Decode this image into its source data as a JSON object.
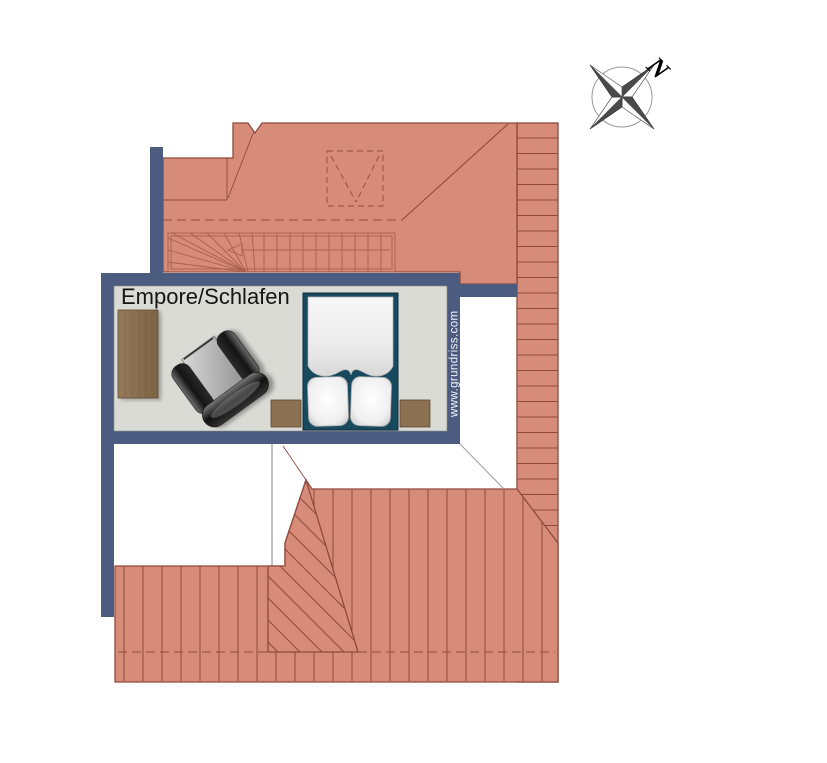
{
  "floor_plan": {
    "room_label": "Empore/Schlafen",
    "watermark": "www.grundriss.com",
    "compass_north": "N",
    "features": [
      "staircase-with-winders",
      "skylight-dashed-symbol",
      "attic-headroom-dashed-line",
      "roof-surface-hatching",
      "dormer-diagonal-hatching",
      "compass-rose"
    ],
    "furniture": [
      "wardrobe-shelf",
      "armchair",
      "double-bed",
      "pillows",
      "nightstand-left",
      "nightstand-right"
    ]
  },
  "colors": {
    "roof": "#D78C7A",
    "roof_line": "#8F4A3B",
    "stair_line": "#A8604C",
    "wall": "#4C5B80",
    "floor": "#DBDBD6",
    "bed_frame": "#17495F",
    "wood": "#8B7052"
  }
}
